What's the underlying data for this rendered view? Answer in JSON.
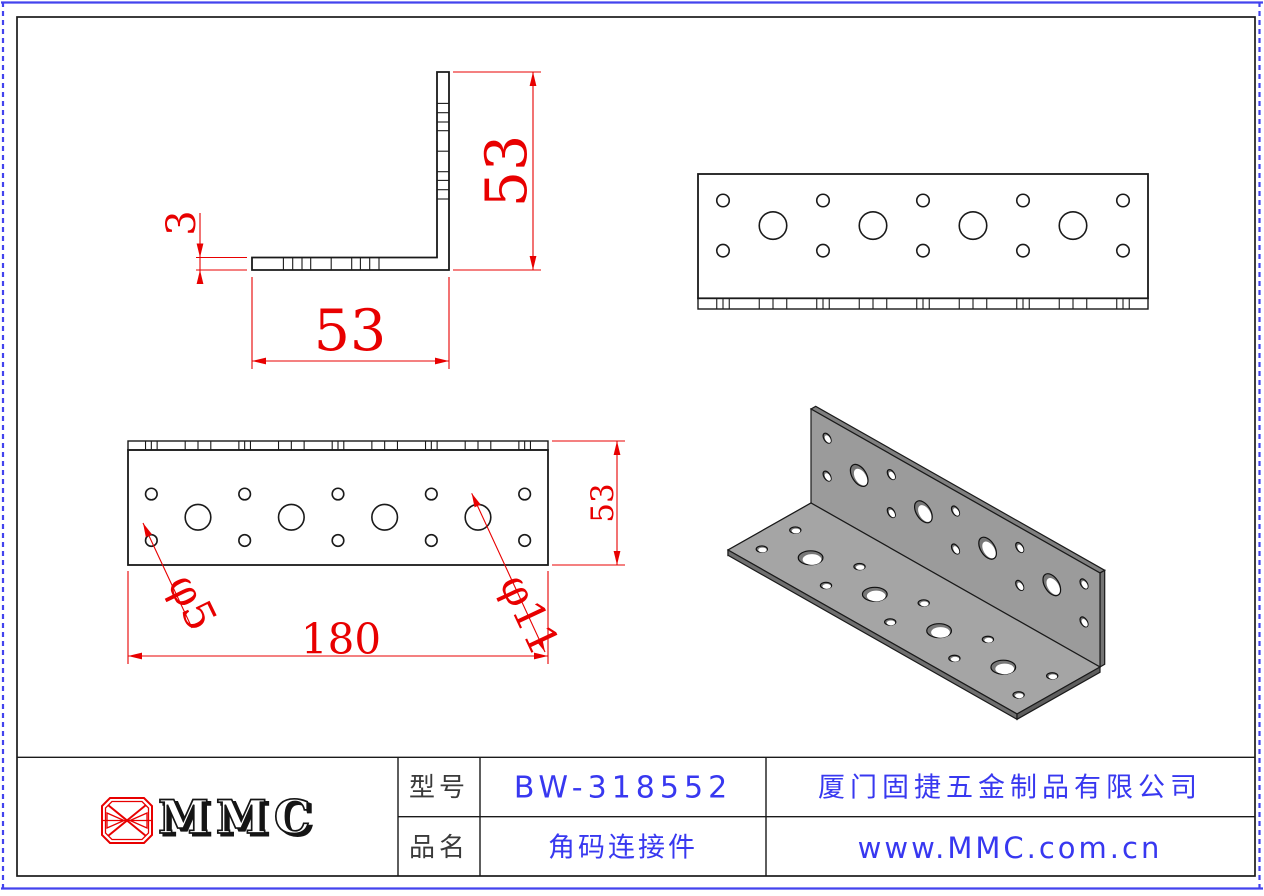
{
  "colors": {
    "dim_red": "#e80000",
    "text_blue": "#3838f0",
    "line_black": "#1a1a1a",
    "border_blue": "#4343ee",
    "metal_front": "#9b9b9b",
    "metal_top": "#a5a5a5",
    "metal_edge_top": "#7f7f7f",
    "metal_edge_right": "#747474",
    "metal_edge_outer": "#6f6f6f",
    "metal_edge_end": "#5e5e5e",
    "metal_edge_left": "#b8b8b8",
    "bore_gray": "#787878"
  },
  "part": {
    "length": 180,
    "leg_width": 53,
    "thickness": 3,
    "small_hole_diameter": 5,
    "large_hole_diameter": 11,
    "small_hole_positions": [
      10,
      50,
      90,
      130,
      170
    ],
    "large_hole_positions": [
      30,
      70,
      110,
      150
    ],
    "hole_row_offsets_from_free_edge": [
      11.3,
      22,
      32.7
    ]
  },
  "views": {
    "side_profile": {
      "height_dim": "53",
      "width_dim": "53",
      "thickness_dim": "3"
    },
    "front_face": {
      "length_dim": "180",
      "width_dim": "53",
      "small_hole_dim": "φ5",
      "large_hole_dim": "φ11"
    }
  },
  "title_block": {
    "logo_text": "MMC",
    "model_label": "型号",
    "model_value": "BW-318552",
    "name_label": "品名",
    "name_value": "角码连接件",
    "company": "厦门固捷五金制品有限公司",
    "website": "www.MMC.com.cn"
  }
}
